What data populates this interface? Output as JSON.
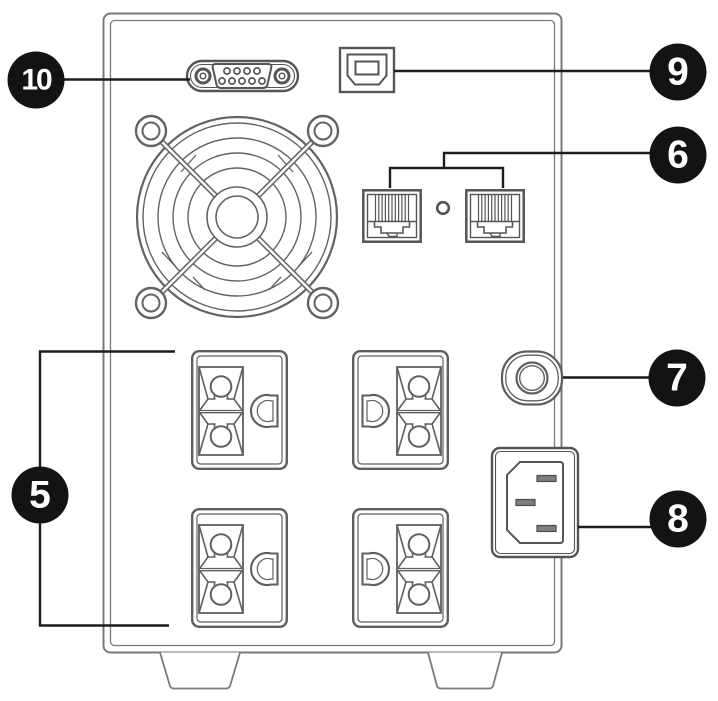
{
  "figure": {
    "kind": "ups-rear-panel-line-diagram",
    "background": "#ffffff",
    "line_color": "#5f5f5f",
    "case_line_color": "#7a7a7a",
    "leader_line_color": "#1d1d1d",
    "callout_bg": "#131313",
    "callout_text_color": "#ffffff",
    "components": [
      "power-outlets",
      "network-ports",
      "breaker-button",
      "ac-inlet",
      "usb-port",
      "serial-port",
      "fan-grille",
      "feet"
    ],
    "callouts": [
      {
        "label": "5"
      },
      {
        "label": "6"
      },
      {
        "label": "7"
      },
      {
        "label": "8"
      },
      {
        "label": "9"
      },
      {
        "label": "10"
      }
    ]
  }
}
